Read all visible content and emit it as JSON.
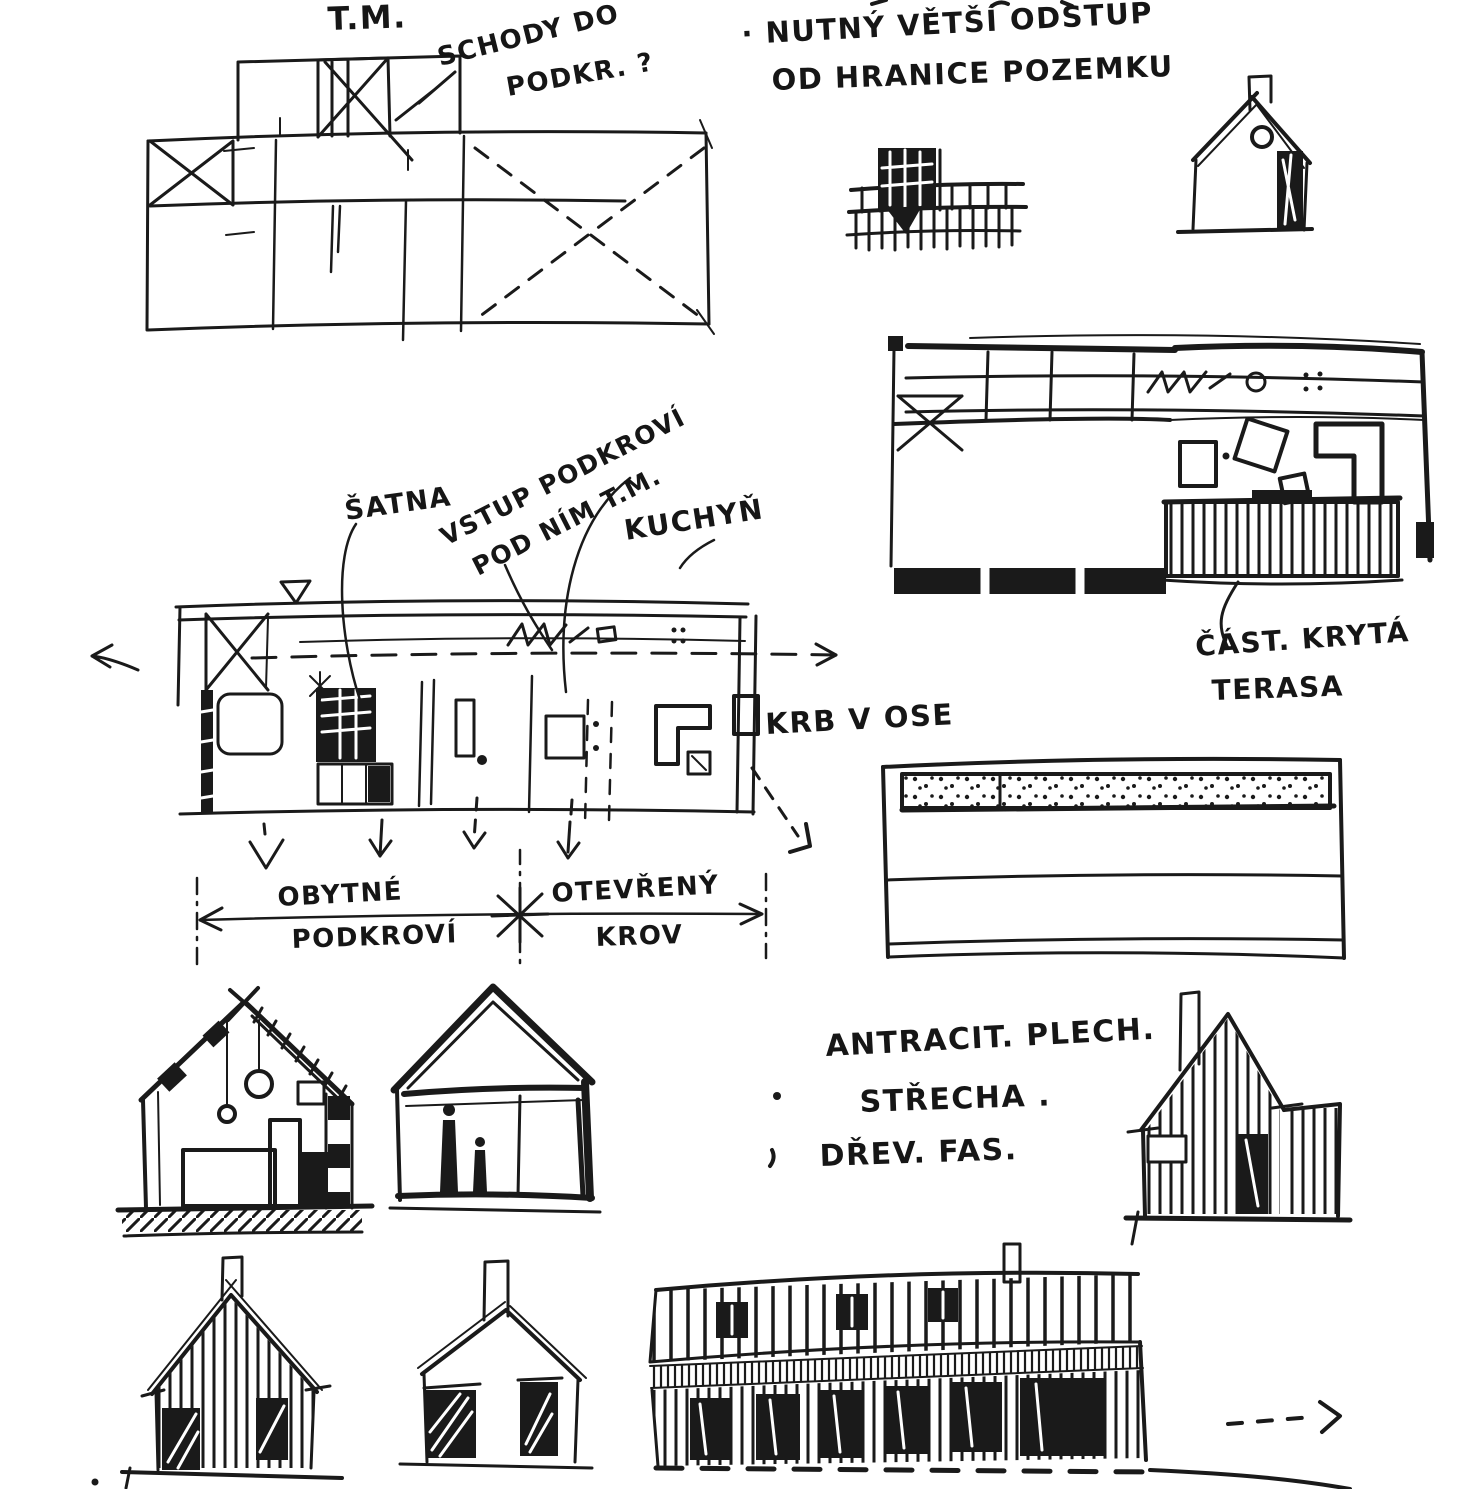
{
  "page": {
    "description": "Hand-drawn architectural concept sketch page with Czech annotations",
    "paper_color": "#ffffff",
    "ink_color": "#1a1a1a"
  },
  "annotations": {
    "tm": "T.M.",
    "schody1": "SCHODY DO",
    "schody2": "PODKR. ?",
    "setback1": "· NUTNÝ VĚTŠÍ ODSTUP",
    "setback2": "OD HRANICE POZEMKU",
    "satna": "ŠATNA",
    "vstup1": "VSTUP PODKROVÍ",
    "vstup2": "POD NÍM T.M.",
    "kuchyn": "KUCHYŇ",
    "krb": "KRB V OSE",
    "terasa1": "ČÁST. KRYTÁ",
    "terasa2": "TERASA",
    "dim_left1": "OBYTNÉ",
    "dim_left2": "PODKROVÍ",
    "dim_right1": "OTEVŘENÝ",
    "dim_right2": "KROV",
    "mat1": "ANTRACIT. PLECH.",
    "mat2": "STŘECHA .",
    "mat3": "DŘEV. FAS."
  }
}
